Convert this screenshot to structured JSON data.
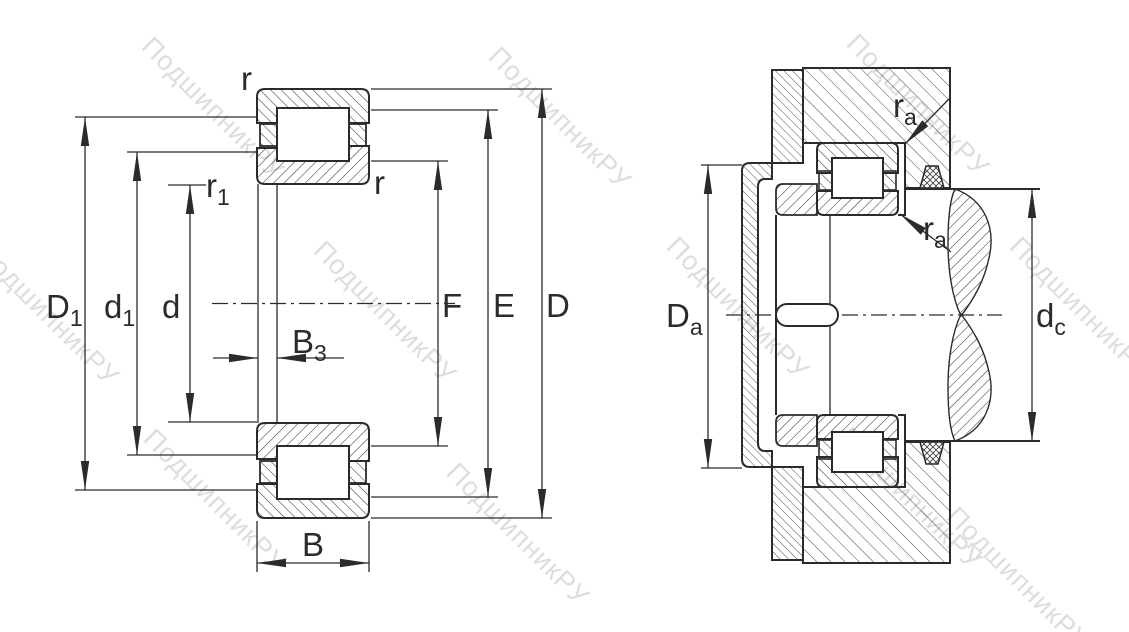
{
  "diagram_type": "bearing-technical-drawing",
  "watermark": {
    "text": "ПодшипникРУ"
  },
  "colors": {
    "line": "#2b2b2b",
    "watermark": "#c3c3c3",
    "background": "#ffffff"
  },
  "left_view": {
    "description": "cylindrical-roller-bearing-cross-section",
    "labels": {
      "D1": {
        "main": "D",
        "sub": "1"
      },
      "d1": {
        "main": "d",
        "sub": "1"
      },
      "d": {
        "main": "d",
        "sub": ""
      },
      "B3": {
        "main": "B",
        "sub": "3"
      },
      "B": {
        "main": "B",
        "sub": ""
      },
      "F": {
        "main": "F",
        "sub": ""
      },
      "E": {
        "main": "E",
        "sub": ""
      },
      "D": {
        "main": "D",
        "sub": ""
      },
      "r_top": {
        "main": "r",
        "sub": ""
      },
      "r_inner": {
        "main": "r",
        "sub": ""
      },
      "r1": {
        "main": "r",
        "sub": "1"
      }
    }
  },
  "right_view": {
    "description": "mounted-bearing-arrangement-section",
    "labels": {
      "Da": {
        "main": "D",
        "sub": "a"
      },
      "dc": {
        "main": "d",
        "sub": "c"
      },
      "ra_top": {
        "main": "r",
        "sub": "a"
      },
      "ra_bottom": {
        "main": "r",
        "sub": "a"
      }
    }
  }
}
